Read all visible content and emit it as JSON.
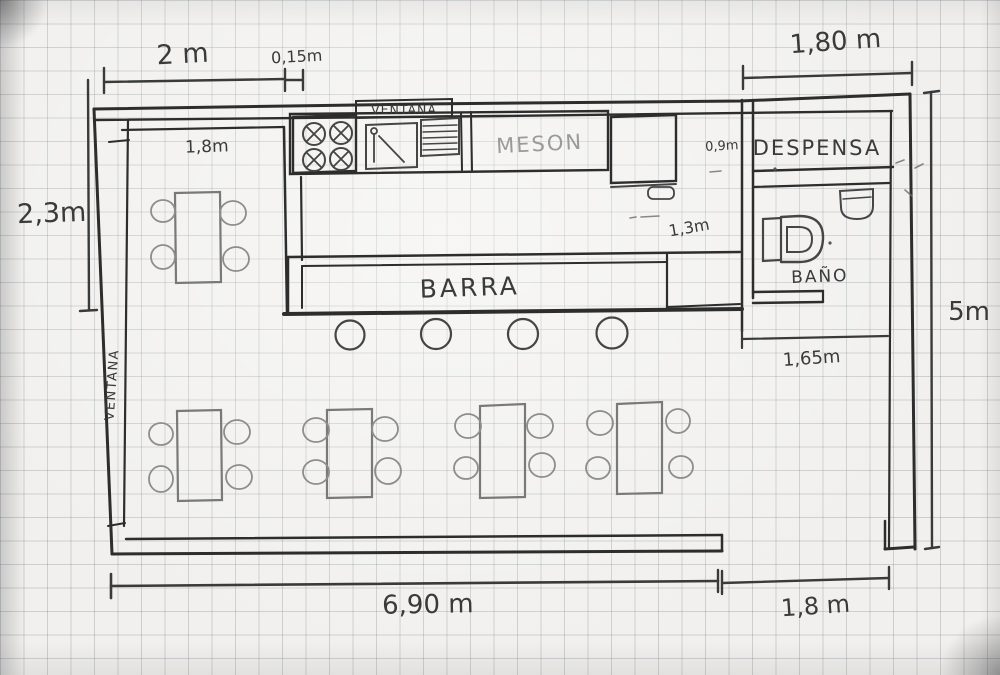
{
  "labels": {
    "window_top": "VENTANA",
    "counter": "MESON",
    "pantry": "DESPENSA",
    "bathroom": "BAÑO",
    "bar": "BARRA",
    "window_left": "VENTANA"
  },
  "dimensions": {
    "top_left_width": "2 m",
    "wall_thickness": "0,15m",
    "top_right_width": "1,80 m",
    "nook_width": "1,8m",
    "left_height": "2,3m",
    "fridge_gap": "0,9m",
    "bar_gap": "1,3m",
    "bathroom_width": "1,65m",
    "right_height": "5m",
    "bottom_main_width": "6,90 m",
    "bottom_entrance_width": "1,8 m"
  }
}
